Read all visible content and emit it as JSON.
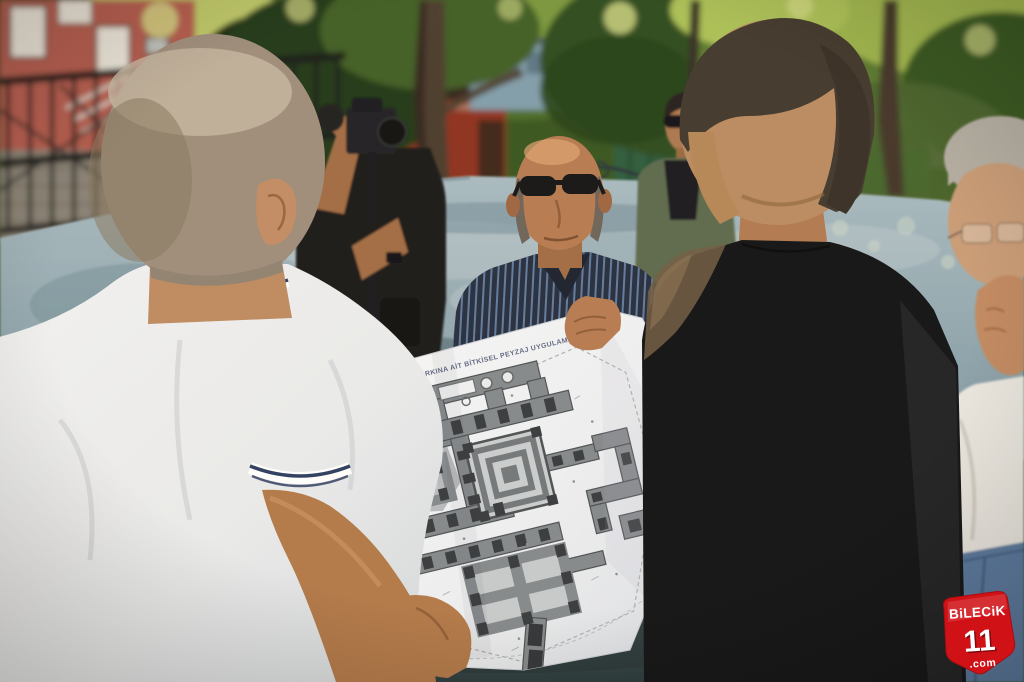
{
  "plan": {
    "title": "DİNGİLLİOĞLU PARKINA AİT BİTKİSEL PEYZAJ UYGULAMA PROJESİ"
  },
  "watermark": {
    "brand": "BiLECiK",
    "number": "11",
    "tld": ".com",
    "bg_color": "#d01217",
    "text_color": "#ffffff"
  },
  "colors": {
    "paper_white": "#f3f4f6",
    "plan_walkway_gray": "#82878c",
    "plan_planter_dark": "#33373b",
    "pavement_blue_gray": "#92a6b0"
  }
}
